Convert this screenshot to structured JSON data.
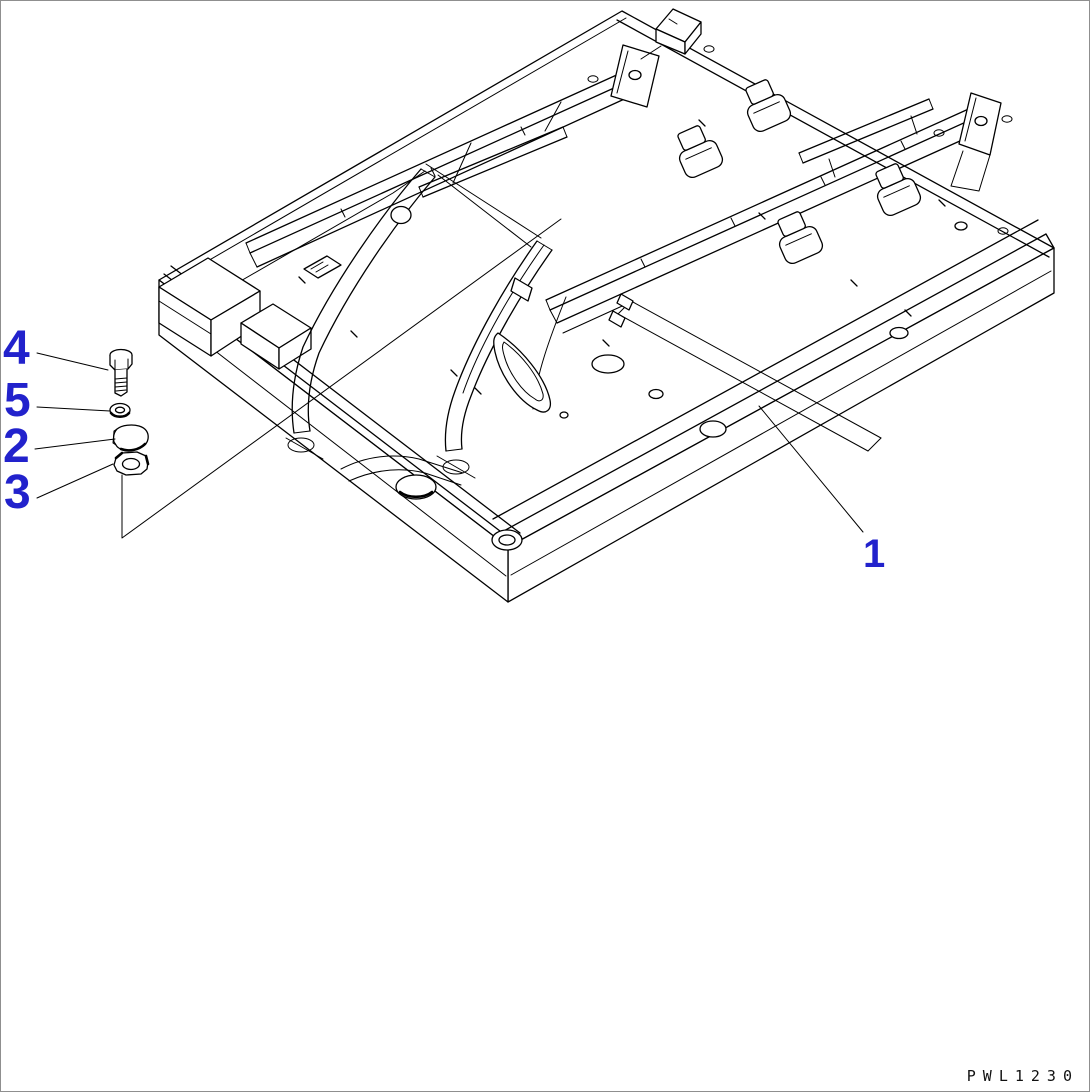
{
  "page": {
    "background": "#ffffff",
    "border_color": "#8f8f8f"
  },
  "colors": {
    "callout": "#2222cc",
    "line": "#000000"
  },
  "callouts": {
    "frame": "1",
    "cap": "2",
    "nut": "3",
    "bolt": "4",
    "washer": "5"
  },
  "footer": {
    "drawing_code": "PWL1230"
  }
}
